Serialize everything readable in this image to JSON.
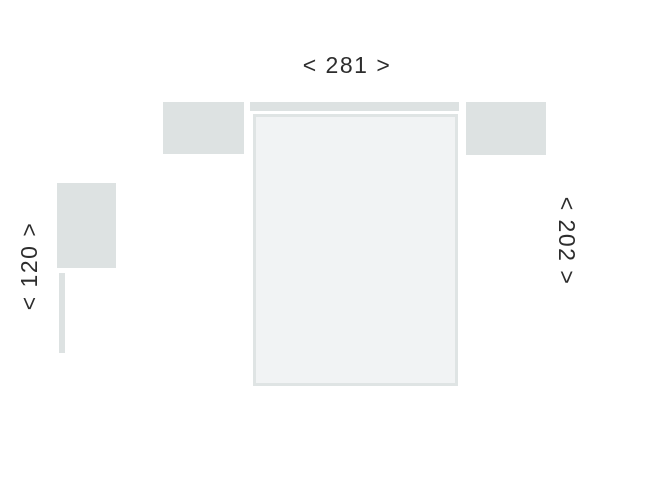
{
  "diagram": {
    "title": "sofa-bed-dimension-diagram",
    "labels": {
      "width": "< 281 >",
      "height": "< 202 >",
      "side": "< 120 >"
    },
    "dimensions": {
      "width": 281,
      "height": 202,
      "side": 120
    },
    "colors": {
      "block": "#dde2e2",
      "bed_border": "#dfe4e4",
      "bed_fill": "#f1f3f4",
      "text": "#2d2d2d",
      "background": "#ffffff"
    }
  }
}
